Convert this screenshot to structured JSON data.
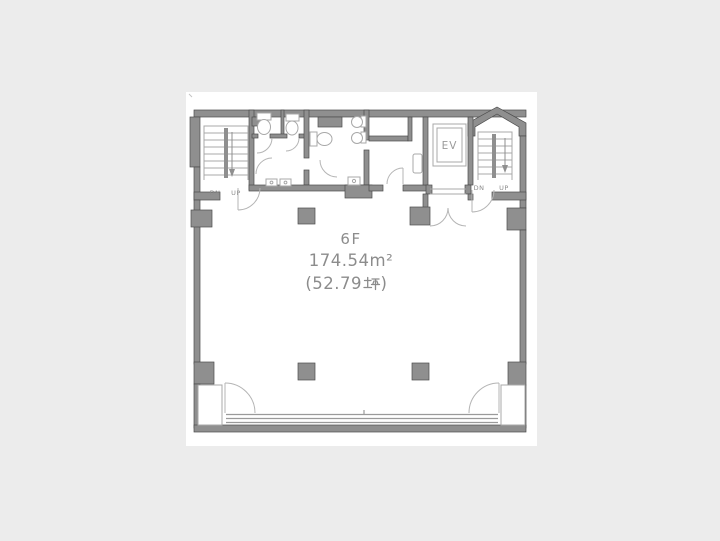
{
  "page": {
    "background_color": "#ececec"
  },
  "floorplan": {
    "labels": {
      "floor": "6F",
      "area_m2": "174.54m²",
      "area_tsubo_full": "(52.79坪)",
      "area_tsubo_prefix": "(52.79",
      "area_tsubo_unit": "坪",
      "area_tsubo_suffix": ")"
    },
    "elevator": {
      "label": "EV"
    },
    "stair_left": {
      "down": "DN",
      "up": "UP"
    },
    "stair_right": {
      "down": "DN",
      "up": "UP"
    },
    "colors": {
      "wall_fill": "#8f8f8f",
      "wall_outline": "#4c4c4c",
      "thin_line": "#a8a8a8",
      "text": "#8c8c8c",
      "plan_background": "#ffffff",
      "page_background": "#ececec"
    }
  }
}
